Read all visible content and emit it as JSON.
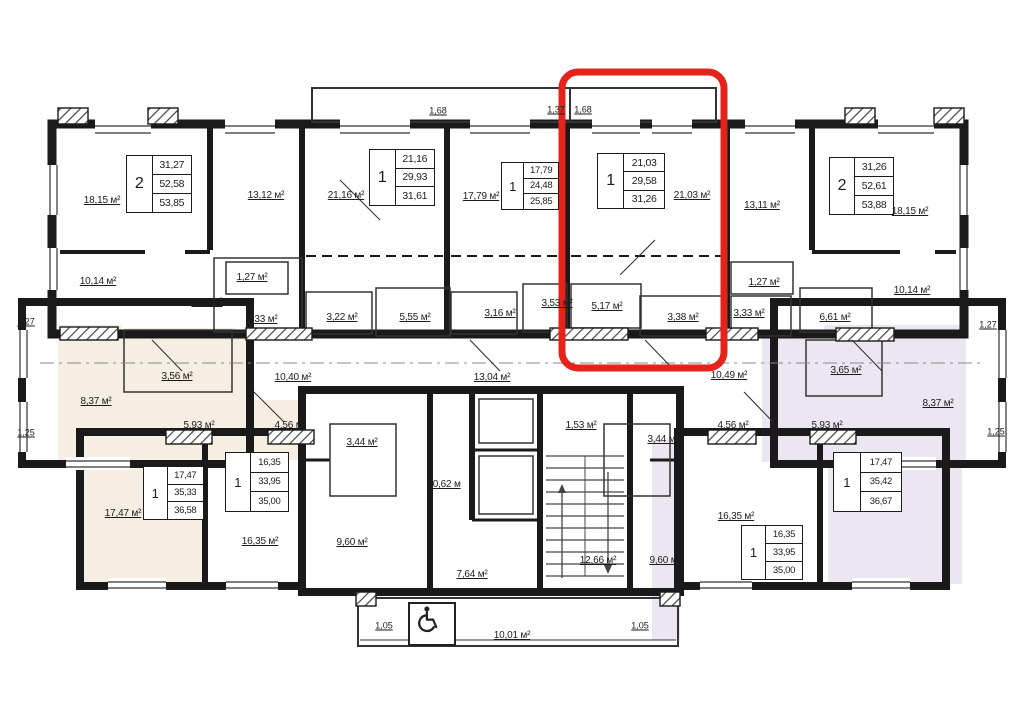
{
  "plan": {
    "title": "Floor plan",
    "highlight_color": "#e5231b",
    "tints": {
      "left_wing": "#f6eee3",
      "right_wing": "#eae7f3"
    },
    "apartments": [
      {
        "name": "top-left",
        "rooms": "2",
        "values": [
          "31,27",
          "52,58",
          "53,85"
        ]
      },
      {
        "name": "top-second",
        "rooms": "1",
        "values": [
          "21,16",
          "29,93",
          "31,61"
        ]
      },
      {
        "name": "top-third",
        "rooms": "1",
        "values": [
          "17,79",
          "24,48",
          "25,85"
        ]
      },
      {
        "name": "highlighted",
        "rooms": "1",
        "values": [
          "21,03",
          "29,58",
          "31,26"
        ],
        "highlighted": true
      },
      {
        "name": "top-right",
        "rooms": "2",
        "values": [
          "31,26",
          "52,61",
          "53,88"
        ]
      },
      {
        "name": "bottom-left",
        "rooms": "1",
        "values": [
          "17,47",
          "35,33",
          "36,58"
        ]
      },
      {
        "name": "bottom-second",
        "rooms": "1",
        "values": [
          "16,35",
          "33,95",
          "35,00"
        ]
      },
      {
        "name": "bottom-third",
        "rooms": "1",
        "values": [
          "16,35",
          "33,95",
          "35,00"
        ]
      },
      {
        "name": "bottom-right",
        "rooms": "1",
        "values": [
          "17,47",
          "35,42",
          "36,67"
        ]
      }
    ],
    "room_labels": [
      "18,15 м²",
      "13,12 м²",
      "21,16 м²",
      "17,79 м²",
      "21,03 м²",
      "13,11 м²",
      "18,15 м²",
      "10,14 м²",
      "6,57 м²",
      "1,27 м²",
      "3,33 м²",
      "3,22 м²",
      "5,55 м²",
      "3,16 м²",
      "3,53 м²",
      "5,17 м²",
      "3,38 м²",
      "3,33 м²",
      "1,27 м²",
      "6,61 м²",
      "10,14 м²",
      "3,56 м²",
      "8,37 м²",
      "10,40 м²",
      "5,93 м²",
      "4,56 м²",
      "13,04 м²",
      "3,44 м²",
      "1,53 м²",
      "10,62 м",
      "9,60 м²",
      "7,64 м²",
      "12,66 м²",
      "3,44 м²",
      "4,56 м²",
      "5,93 м²",
      "3,65 м²",
      "8,37 м²",
      "10,49 м²",
      "9,60 м²",
      "16,35 м²",
      "17,47 м²",
      "16,35 м²",
      "10,01 м²"
    ],
    "dimensions": [
      "1,68",
      "1,37",
      "1,68",
      "1,27",
      "1,25",
      "1,27",
      "1,25",
      "1,05",
      "1,05"
    ],
    "icons": {
      "wheelchair": "wheelchair"
    }
  }
}
